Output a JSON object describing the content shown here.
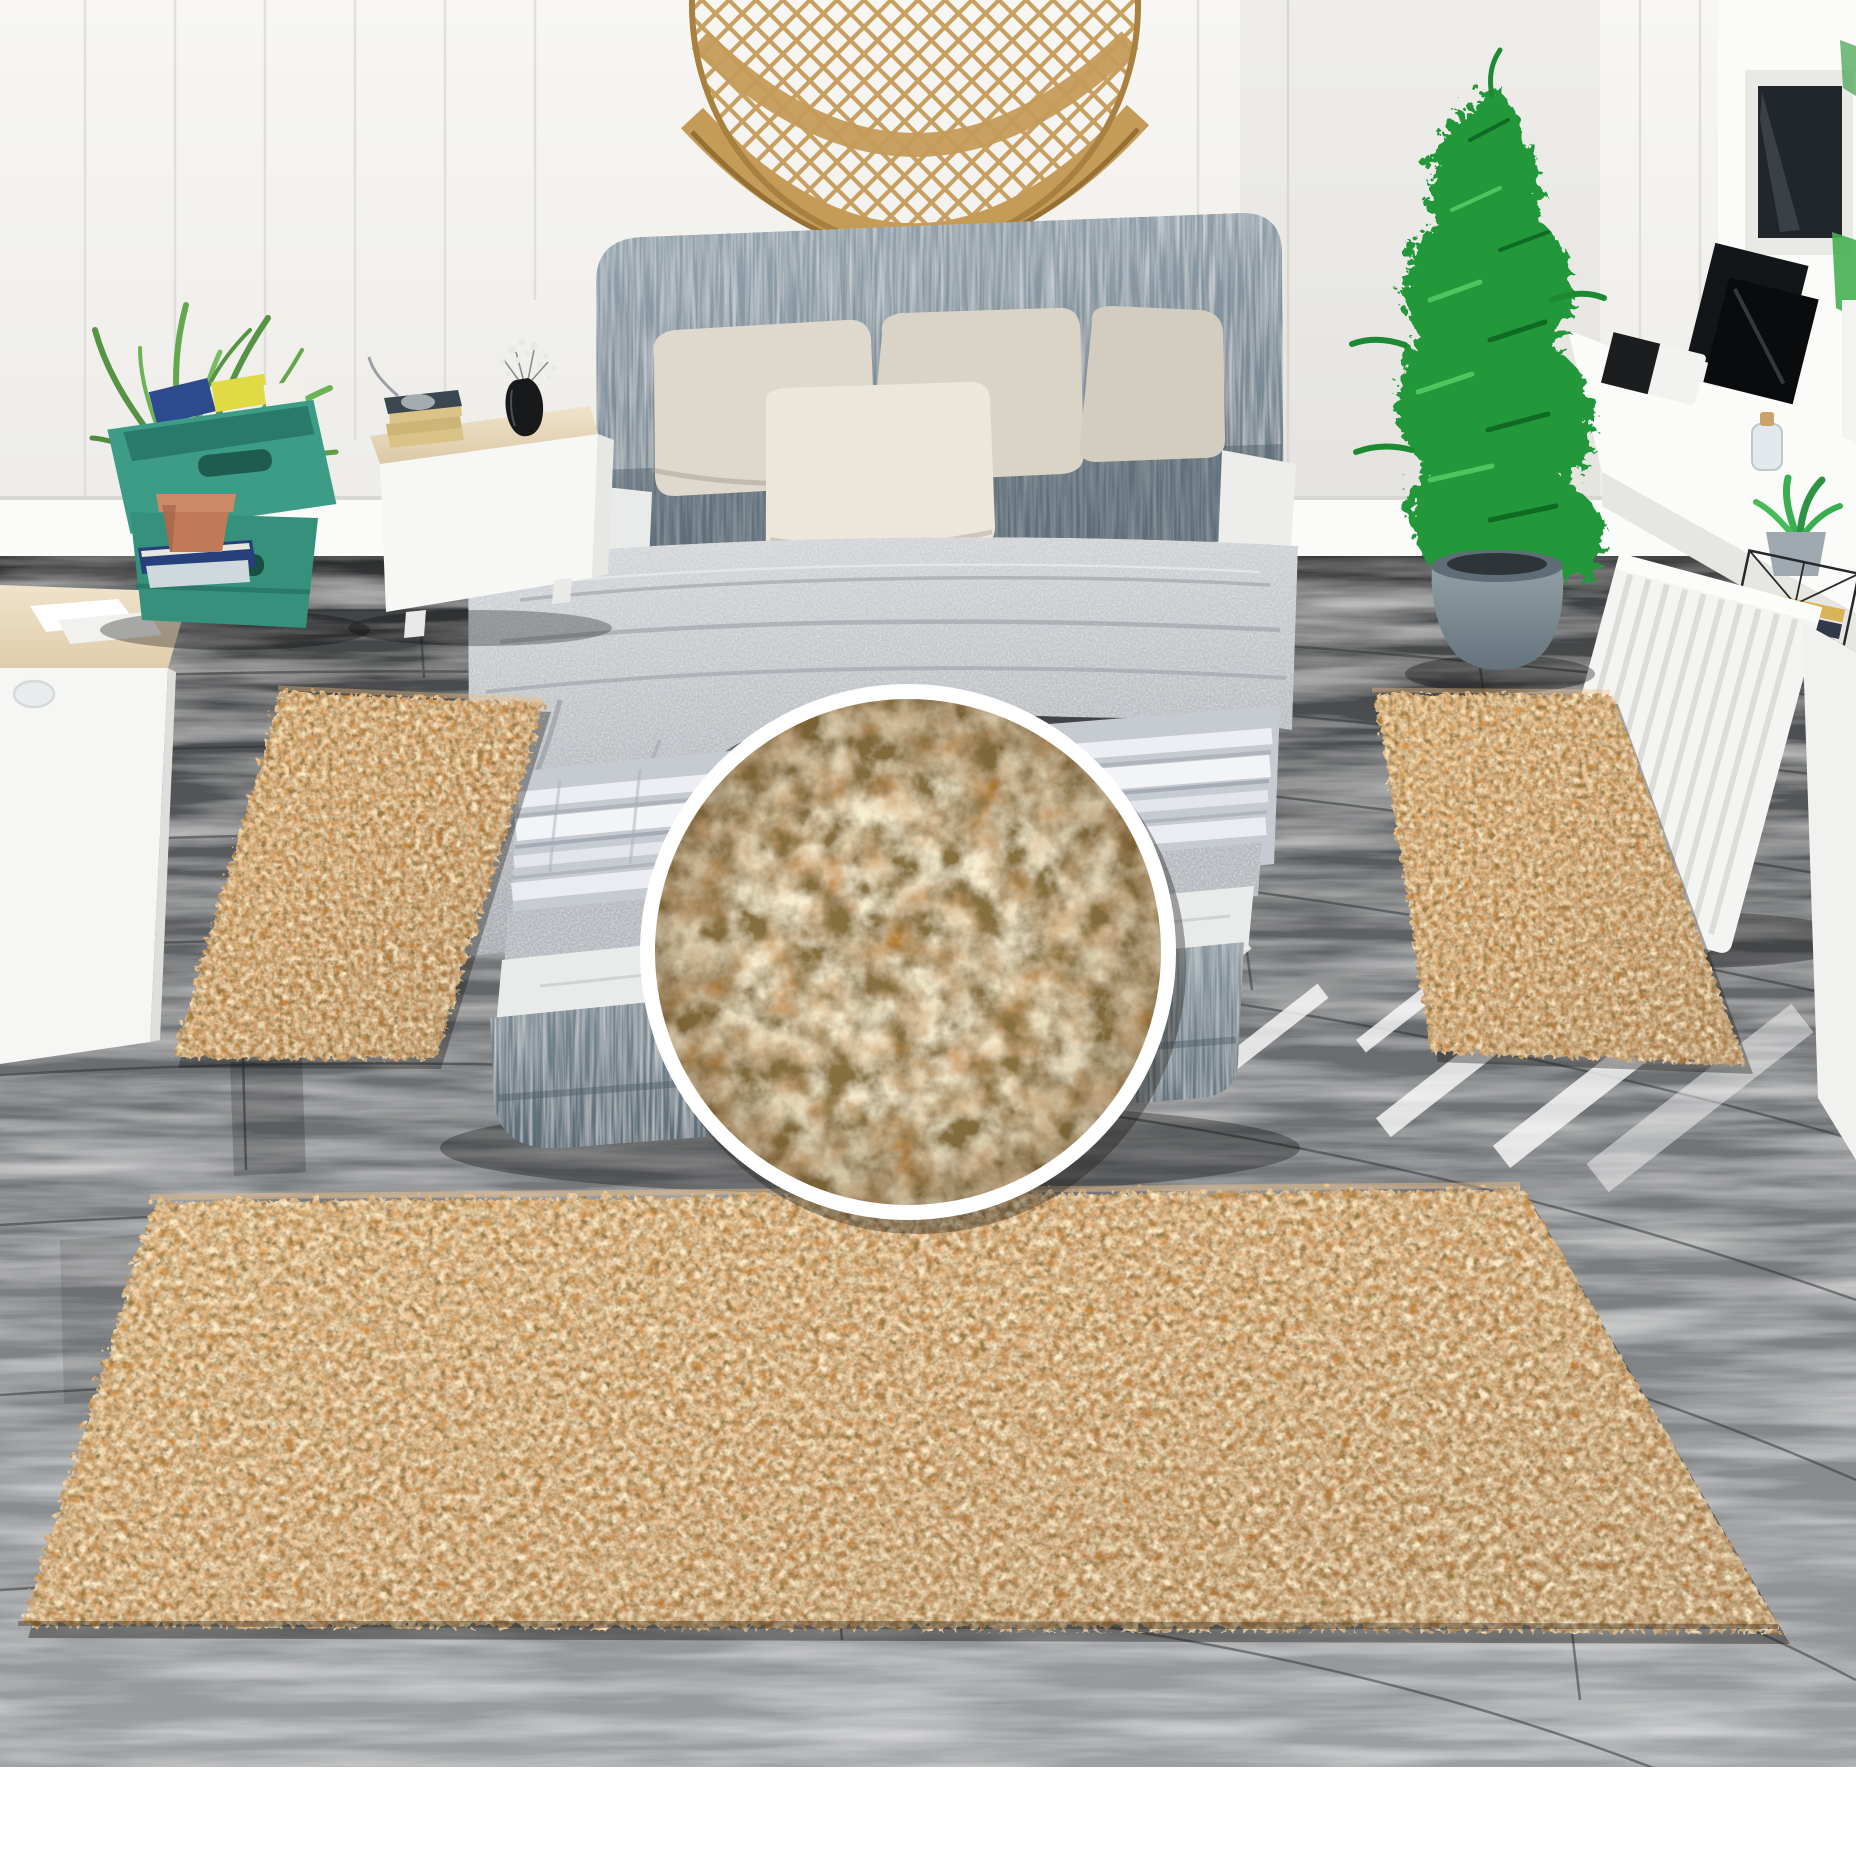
{
  "scene": {
    "kind": "product-photograph",
    "subject": "three-piece rust-orange shag rug set arranged around a gray platform bed, with circular rug-pile texture zoom inset",
    "canvas": {
      "width": 1856,
      "height": 1855
    },
    "regions": {
      "left_runner_rug": "left of bed on gray wood floor",
      "right_runner_rug": "right of bed on gray wood floor",
      "foot_runner_rug": "large runner across foot of bed",
      "texture_inset": "circular macro view of shag pile, center of image",
      "white_margin_bottom_px": 88
    }
  },
  "colors": {
    "background": "#ffffff",
    "wall_top": "#f7f6f3",
    "wall_bottom": "#ecebe7",
    "wall_groove": "#dcd9d4",
    "baseboard": "#fbfbf9",
    "floor_dark": "#3d3f41",
    "floor_mid": "#6e7174",
    "floor_light": "#9da0a3",
    "plank_seam": "#2c2f31",
    "rug_light": "#e2a558",
    "rug_mid": "#cf8a3e",
    "rug_dark": "#a96a2b",
    "rug_zoom_base": "#bf8433",
    "rug_zoom_tuft": "#ecd6a4",
    "rug_zoom_gap": "#3f2d12",
    "headboard_light": "#96a5af",
    "headboard_dark": "#6b7b85",
    "bed_base_light": "#87969f",
    "bed_base_dark": "#5a6b75",
    "duvet_light": "#d4d7db",
    "duvet_dark": "#a4a9ae",
    "satin_light": "#eef0f4",
    "satin_mid": "#c6cbd2",
    "pillow": "#ded9cc",
    "pillow_front": "#ece7db",
    "sheet": "#e9ebea",
    "rattan": "#c59b58",
    "rattan_dark": "#8f6a30",
    "crate": "#3d9c86",
    "crate_dark": "#1d5c4e",
    "fern": "#5f9e45",
    "terracotta": "#c07a57",
    "plant": "#21983a",
    "plant_dark": "#0f6b24",
    "plant_light": "#52c45f",
    "pot_light": "#95a2a9",
    "pot_dark": "#64737c",
    "wood_top_light": "#f0e3cb",
    "wood_top_dark": "#dcc8a6",
    "book_cover": "#3a4750",
    "book_pages": "#d9c387",
    "vase_black": "#17191b",
    "frame_black": "#131619",
    "window_pane": "#20262b",
    "window_green": "#46b152",
    "radiator": "#f4f4f2",
    "sunbeam": "#ffffff"
  }
}
